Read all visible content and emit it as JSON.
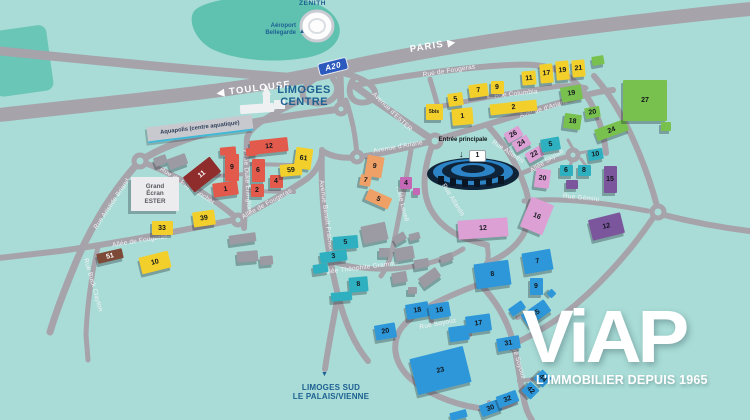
{
  "colors": {
    "background": "#a9dcd6",
    "road": "#a6a3ab",
    "greenspace": "#5fc2b0",
    "label_blue": "#1d6092",
    "red": "#e25a4c",
    "darkred": "#8e2d2b",
    "brown": "#7d4a38",
    "yellow": "#f2cf2b",
    "orange": "#efa066",
    "pink": "#dda0d5",
    "plum": "#c468b6",
    "purple": "#7b569d",
    "teal": "#2fb0c0",
    "green": "#78c14e",
    "blue": "#2d97da",
    "gray": "#9c9aa2"
  },
  "icons": {
    "airport_marker": "▲",
    "sud_marker": "▼",
    "entrance_arrow": "↓",
    "arrow_right": "▶",
    "arrow_left": "◀"
  },
  "places": {
    "zenith": {
      "label": "ZENITH"
    },
    "airport": {
      "label": "Aéroport Bellegarde"
    },
    "limoges_centre": {
      "line1": "LIMOGES",
      "line2": "CENTRE"
    },
    "limoges_sud": {
      "line1": "LIMOGES SUD",
      "line2": "LE PALAIS/VIENNE"
    },
    "aquapolis": {
      "label": "Aquapolis (centre aquatique)"
    },
    "grand_ecran": {
      "label": "Grand Écran ESTER"
    },
    "entrance": {
      "label": "Entrée principale",
      "badge": "1"
    }
  },
  "highway_signs": [
    {
      "text": "PARIS",
      "arrow": "right",
      "x": 433,
      "y": 46,
      "rot": -9
    },
    {
      "text": "TOULOUSE",
      "arrow": "left",
      "x": 254,
      "y": 89,
      "rot": -7
    }
  ],
  "badges": [
    {
      "text": "A20",
      "x": 318,
      "y": 60,
      "rot": -14
    }
  ],
  "streets": [
    {
      "name": "Rue de Fougeras",
      "x": 449,
      "y": 71,
      "rot": -9
    },
    {
      "name": "Rue Columbia",
      "x": 516,
      "y": 94,
      "rot": -6
    },
    {
      "name": "Avenue d'Ariane",
      "x": 398,
      "y": 147,
      "rot": -10
    },
    {
      "name": "Avenue d'Ariane",
      "x": 544,
      "y": 109,
      "rot": -17
    },
    {
      "name": "Avenue d'ESTER",
      "x": 392,
      "y": 112,
      "rot": 44
    },
    {
      "name": "Rue du Puy Ponchet",
      "x": 187,
      "y": 186,
      "rot": 33
    },
    {
      "name": "Allée Duke Ellington",
      "x": 247,
      "y": 181,
      "rot": 86
    },
    {
      "name": "Allée de Fougeras",
      "x": 140,
      "y": 241,
      "rot": -9
    },
    {
      "name": "Allée de Fougeras",
      "x": 267,
      "y": 204,
      "rot": -29
    },
    {
      "name": "Rue Buck Clayton",
      "x": 93,
      "y": 285,
      "rot": 74
    },
    {
      "name": "Rue Aristide Briand",
      "x": 112,
      "y": 204,
      "rot": -56
    },
    {
      "name": "Avenue Benoît Frachon",
      "x": 326,
      "y": 216,
      "rot": 82
    },
    {
      "name": "Allée Théophile Gramme",
      "x": 361,
      "y": 268,
      "rot": -7
    },
    {
      "name": "Allée Lovell",
      "x": 402,
      "y": 204,
      "rot": 76
    },
    {
      "name": "Allée Skylab",
      "x": 547,
      "y": 161,
      "rot": -33
    },
    {
      "name": "Rue Atlantis",
      "x": 508,
      "y": 152,
      "rot": 33
    },
    {
      "name": "Rue Atlantis",
      "x": 453,
      "y": 200,
      "rot": 58
    },
    {
      "name": "Rue Gémini",
      "x": 581,
      "y": 198,
      "rot": 6
    },
    {
      "name": "Rue Soyouz",
      "x": 438,
      "y": 324,
      "rot": -11
    },
    {
      "name": "Rue Soyouz",
      "x": 518,
      "y": 361,
      "rot": 73
    }
  ],
  "buildings": [
    {
      "n": "12",
      "x": 269,
      "y": 146,
      "w": 38,
      "h": 14,
      "r": -6,
      "c": "red"
    },
    {
      "n": "",
      "x": 228,
      "y": 151,
      "w": 16,
      "h": 8,
      "r": -5,
      "c": "red"
    },
    {
      "n": "",
      "x": 251,
      "y": 152,
      "w": 11,
      "h": 8,
      "r": -5,
      "c": "red"
    },
    {
      "n": "11",
      "x": 202,
      "y": 174,
      "w": 34,
      "h": 19,
      "r": -38,
      "c": "darkred",
      "t": 1
    },
    {
      "n": "9",
      "x": 232,
      "y": 167,
      "w": 14,
      "h": 27,
      "r": 0,
      "c": "red"
    },
    {
      "n": "6",
      "x": 258,
      "y": 170,
      "w": 13,
      "h": 23,
      "r": 0,
      "c": "red"
    },
    {
      "n": "4",
      "x": 276,
      "y": 181,
      "w": 13,
      "h": 13,
      "r": 0,
      "c": "red"
    },
    {
      "n": "2",
      "x": 257,
      "y": 190,
      "w": 13,
      "h": 13,
      "r": 0,
      "c": "red"
    },
    {
      "n": "1",
      "x": 225,
      "y": 189,
      "w": 25,
      "h": 14,
      "r": -8,
      "c": "red"
    },
    {
      "n": "51",
      "x": 110,
      "y": 256,
      "w": 26,
      "h": 10,
      "r": -13,
      "c": "brown",
      "t": 1
    },
    {
      "n": "39",
      "x": 204,
      "y": 218,
      "w": 22,
      "h": 15,
      "r": -8,
      "c": "yellow"
    },
    {
      "n": "33",
      "x": 162,
      "y": 228,
      "w": 21,
      "h": 14,
      "r": 0,
      "c": "yellow"
    },
    {
      "n": "10",
      "x": 155,
      "y": 262,
      "w": 30,
      "h": 17,
      "r": -14,
      "c": "yellow"
    },
    {
      "n": "61",
      "x": 303,
      "y": 158,
      "w": 17,
      "h": 21,
      "r": 8,
      "c": "yellow"
    },
    {
      "n": "59",
      "x": 291,
      "y": 170,
      "w": 22,
      "h": 12,
      "r": -5,
      "c": "yellow"
    },
    {
      "n": "5bis",
      "x": 434,
      "y": 112,
      "w": 17,
      "h": 16,
      "r": 0,
      "c": "yellow"
    },
    {
      "n": "1",
      "x": 462,
      "y": 116,
      "w": 21,
      "h": 17,
      "r": -5,
      "c": "yellow"
    },
    {
      "n": "5",
      "x": 455,
      "y": 99,
      "w": 15,
      "h": 13,
      "r": -8,
      "c": "yellow"
    },
    {
      "n": "7",
      "x": 478,
      "y": 90,
      "w": 19,
      "h": 13,
      "r": -8,
      "c": "yellow"
    },
    {
      "n": "9",
      "x": 497,
      "y": 87,
      "w": 13,
      "h": 13,
      "r": 0,
      "c": "yellow"
    },
    {
      "n": "2",
      "x": 513,
      "y": 107,
      "w": 47,
      "h": 11,
      "r": -6,
      "c": "yellow"
    },
    {
      "n": "11",
      "x": 529,
      "y": 78,
      "w": 14,
      "h": 14,
      "r": -5,
      "c": "yellow"
    },
    {
      "n": "17",
      "x": 546,
      "y": 73,
      "w": 13,
      "h": 19,
      "r": -5,
      "c": "yellow"
    },
    {
      "n": "19",
      "x": 562,
      "y": 70,
      "w": 13,
      "h": 19,
      "r": -5,
      "c": "yellow"
    },
    {
      "n": "21",
      "x": 578,
      "y": 68,
      "w": 13,
      "h": 17,
      "r": -5,
      "c": "yellow"
    },
    {
      "n": "9",
      "x": 374,
      "y": 166,
      "w": 17,
      "h": 21,
      "r": 10,
      "c": "orange"
    },
    {
      "n": "7",
      "x": 365,
      "y": 180,
      "w": 11,
      "h": 11,
      "r": 10,
      "c": "orange"
    },
    {
      "n": "5",
      "x": 378,
      "y": 199,
      "w": 25,
      "h": 12,
      "r": 24,
      "c": "orange"
    },
    {
      "n": "4",
      "x": 406,
      "y": 183,
      "w": 12,
      "h": 12,
      "r": 0,
      "c": "plum"
    },
    {
      "n": "",
      "x": 416,
      "y": 191,
      "w": 7,
      "h": 7,
      "r": 0,
      "c": "plum"
    },
    {
      "n": "26",
      "x": 513,
      "y": 134,
      "w": 17,
      "h": 11,
      "r": -30,
      "c": "pink"
    },
    {
      "n": "24",
      "x": 521,
      "y": 143,
      "w": 17,
      "h": 11,
      "r": -30,
      "c": "pink"
    },
    {
      "n": "22",
      "x": 534,
      "y": 154,
      "w": 17,
      "h": 11,
      "r": -30,
      "c": "pink"
    },
    {
      "n": "20",
      "x": 542,
      "y": 178,
      "w": 15,
      "h": 19,
      "r": 8,
      "c": "pink"
    },
    {
      "n": "12",
      "x": 483,
      "y": 228,
      "w": 50,
      "h": 19,
      "r": -4,
      "c": "pink"
    },
    {
      "n": "16",
      "x": 537,
      "y": 216,
      "w": 24,
      "h": 32,
      "r": 22,
      "c": "pink"
    },
    {
      "n": "15",
      "x": 610,
      "y": 179,
      "w": 13,
      "h": 27,
      "r": 0,
      "c": "purple"
    },
    {
      "n": "12",
      "x": 606,
      "y": 226,
      "w": 33,
      "h": 21,
      "r": -14,
      "c": "purple"
    },
    {
      "n": "",
      "x": 572,
      "y": 184,
      "w": 12,
      "h": 9,
      "r": 0,
      "c": "purple"
    },
    {
      "n": "5",
      "x": 550,
      "y": 144,
      "w": 19,
      "h": 13,
      "r": -10,
      "c": "teal"
    },
    {
      "n": "6",
      "x": 566,
      "y": 170,
      "w": 13,
      "h": 11,
      "r": 0,
      "c": "teal"
    },
    {
      "n": "8",
      "x": 584,
      "y": 170,
      "w": 13,
      "h": 11,
      "r": 0,
      "c": "teal"
    },
    {
      "n": "10",
      "x": 595,
      "y": 154,
      "w": 15,
      "h": 11,
      "r": -10,
      "c": "teal"
    },
    {
      "n": "5",
      "x": 345,
      "y": 242,
      "w": 25,
      "h": 13,
      "r": -5,
      "c": "teal"
    },
    {
      "n": "3",
      "x": 333,
      "y": 256,
      "w": 27,
      "h": 11,
      "r": -8,
      "c": "teal"
    },
    {
      "n": "8",
      "x": 358,
      "y": 284,
      "w": 19,
      "h": 15,
      "r": -5,
      "c": "teal"
    },
    {
      "n": "",
      "x": 320,
      "y": 268,
      "w": 15,
      "h": 9,
      "r": -8,
      "c": "teal"
    },
    {
      "n": "",
      "x": 341,
      "y": 296,
      "w": 21,
      "h": 9,
      "r": -5,
      "c": "teal"
    },
    {
      "n": "19",
      "x": 571,
      "y": 93,
      "w": 21,
      "h": 15,
      "r": -10,
      "c": "green"
    },
    {
      "n": "20",
      "x": 592,
      "y": 112,
      "w": 15,
      "h": 11,
      "r": -10,
      "c": "green"
    },
    {
      "n": "18",
      "x": 572,
      "y": 121,
      "w": 17,
      "h": 15,
      "r": 8,
      "c": "green"
    },
    {
      "n": "24",
      "x": 611,
      "y": 130,
      "w": 33,
      "h": 12,
      "r": -20,
      "c": "green"
    },
    {
      "n": "27",
      "x": 645,
      "y": 100,
      "w": 44,
      "h": 41,
      "r": 0,
      "c": "green"
    },
    {
      "n": "",
      "x": 598,
      "y": 60,
      "w": 12,
      "h": 9,
      "r": -10,
      "c": "green"
    },
    {
      "n": "",
      "x": 666,
      "y": 126,
      "w": 10,
      "h": 9,
      "r": 0,
      "c": "green"
    },
    {
      "n": "7",
      "x": 537,
      "y": 261,
      "w": 29,
      "h": 21,
      "r": -10,
      "c": "blue"
    },
    {
      "n": "8",
      "x": 492,
      "y": 274,
      "w": 35,
      "h": 25,
      "r": -8,
      "c": "blue"
    },
    {
      "n": "9",
      "x": 536,
      "y": 286,
      "w": 13,
      "h": 17,
      "r": 0,
      "c": "blue"
    },
    {
      "n": "",
      "x": 551,
      "y": 293,
      "w": 7,
      "h": 7,
      "r": 45,
      "c": "blue"
    },
    {
      "n": "18",
      "x": 417,
      "y": 310,
      "w": 23,
      "h": 15,
      "r": -10,
      "c": "blue"
    },
    {
      "n": "16",
      "x": 439,
      "y": 310,
      "w": 21,
      "h": 15,
      "r": -10,
      "c": "blue"
    },
    {
      "n": "20",
      "x": 385,
      "y": 331,
      "w": 21,
      "h": 15,
      "r": -10,
      "c": "blue"
    },
    {
      "n": "17",
      "x": 478,
      "y": 323,
      "w": 25,
      "h": 17,
      "r": -8,
      "c": "blue"
    },
    {
      "n": "",
      "x": 459,
      "y": 333,
      "w": 20,
      "h": 15,
      "r": -8,
      "c": "blue"
    },
    {
      "n": "35",
      "x": 536,
      "y": 313,
      "w": 28,
      "h": 14,
      "r": -35,
      "c": "blue"
    },
    {
      "n": "",
      "x": 517,
      "y": 308,
      "w": 16,
      "h": 9,
      "r": -35,
      "c": "blue"
    },
    {
      "n": "31",
      "x": 508,
      "y": 343,
      "w": 23,
      "h": 13,
      "r": -10,
      "c": "blue"
    },
    {
      "n": "23",
      "x": 440,
      "y": 370,
      "w": 55,
      "h": 37,
      "r": -14,
      "c": "blue"
    },
    {
      "n": "30",
      "x": 490,
      "y": 408,
      "w": 21,
      "h": 12,
      "r": -20,
      "c": "blue"
    },
    {
      "n": "32",
      "x": 507,
      "y": 399,
      "w": 21,
      "h": 12,
      "r": -20,
      "c": "blue"
    },
    {
      "n": "42",
      "x": 530,
      "y": 390,
      "w": 13,
      "h": 13,
      "r": 45,
      "c": "blue"
    },
    {
      "n": "44",
      "x": 542,
      "y": 378,
      "w": 13,
      "h": 13,
      "r": 45,
      "c": "blue"
    },
    {
      "n": "",
      "x": 458,
      "y": 415,
      "w": 17,
      "h": 8,
      "r": -15,
      "c": "blue"
    },
    {
      "n": "",
      "x": 160,
      "y": 160,
      "w": 13,
      "h": 9,
      "r": -20,
      "c": "gray"
    },
    {
      "n": "",
      "x": 177,
      "y": 161,
      "w": 19,
      "h": 11,
      "r": -20,
      "c": "gray"
    },
    {
      "n": "",
      "x": 242,
      "y": 238,
      "w": 27,
      "h": 9,
      "r": -8,
      "c": "gray"
    },
    {
      "n": "",
      "x": 247,
      "y": 256,
      "w": 21,
      "h": 11,
      "r": -5,
      "c": "gray"
    },
    {
      "n": "",
      "x": 266,
      "y": 260,
      "w": 13,
      "h": 9,
      "r": -5,
      "c": "gray"
    },
    {
      "n": "",
      "x": 374,
      "y": 233,
      "w": 25,
      "h": 18,
      "r": -12,
      "c": "gray"
    },
    {
      "n": "",
      "x": 399,
      "y": 238,
      "w": 13,
      "h": 8,
      "r": -30,
      "c": "gray"
    },
    {
      "n": "",
      "x": 414,
      "y": 236,
      "w": 11,
      "h": 7,
      "r": -15,
      "c": "gray"
    },
    {
      "n": "",
      "x": 404,
      "y": 253,
      "w": 19,
      "h": 13,
      "r": -10,
      "c": "gray"
    },
    {
      "n": "",
      "x": 384,
      "y": 252,
      "w": 11,
      "h": 9,
      "r": 0,
      "c": "gray"
    },
    {
      "n": "",
      "x": 421,
      "y": 263,
      "w": 15,
      "h": 9,
      "r": -10,
      "c": "gray"
    },
    {
      "n": "",
      "x": 429,
      "y": 277,
      "w": 21,
      "h": 11,
      "r": -35,
      "c": "gray"
    },
    {
      "n": "",
      "x": 399,
      "y": 277,
      "w": 15,
      "h": 11,
      "r": -10,
      "c": "gray"
    },
    {
      "n": "",
      "x": 412,
      "y": 290,
      "w": 9,
      "h": 7,
      "r": 0,
      "c": "gray"
    },
    {
      "n": "",
      "x": 446,
      "y": 258,
      "w": 13,
      "h": 8,
      "r": -20,
      "c": "gray"
    }
  ],
  "logo": {
    "brand": "ViAP",
    "tagline": "L'IMMOBILIER DEPUIS 1965"
  }
}
